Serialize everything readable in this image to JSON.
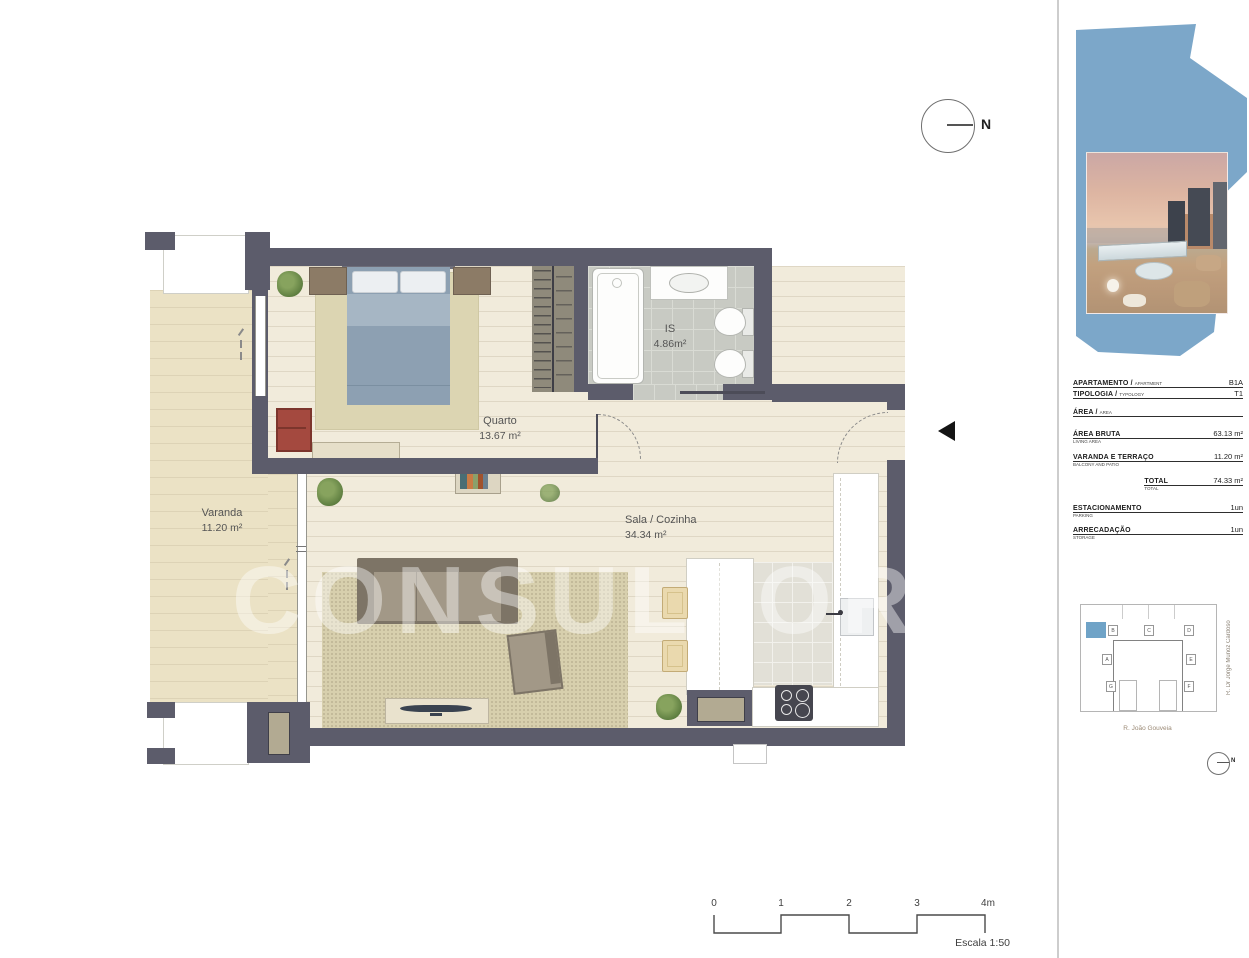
{
  "plan": {
    "watermark": "CONSULTORES",
    "north": {
      "label": "N"
    },
    "rooms": {
      "varanda": {
        "name": "Varanda",
        "area": "11.20 m²"
      },
      "quarto": {
        "name": "Quarto",
        "area": "13.67 m²"
      },
      "is": {
        "name": "IS",
        "area": "4.86m²"
      },
      "sala": {
        "name": "Sala / Cozinha",
        "area": "34.34 m²"
      }
    }
  },
  "sidebar": {
    "info_rows": [
      {
        "pt": "APARTAMENTO /",
        "en": "APARTMENT",
        "value": "B1A"
      },
      {
        "pt": "TIPOLOGIA /",
        "en": "TYPOLOGY",
        "value": "T1"
      },
      {
        "pt": "ÁREA /",
        "en": "AREA",
        "value": ""
      },
      {
        "pt": "ÁREA BRUTA",
        "en": "LIVING AREA",
        "value": "63.13 m²"
      },
      {
        "pt": "VARANDA E TERRAÇO",
        "en": "BALCONY AND PATIO",
        "value": "11.20 m²"
      },
      {
        "pt": "TOTAL",
        "en": "TOTAL",
        "value": "74.33 m²"
      },
      {
        "pt": "ESTACIONAMENTO",
        "en": "PARKING",
        "value": "1un"
      },
      {
        "pt": "ARRECADAÇÃO",
        "en": "STORAGE",
        "value": "1un"
      }
    ],
    "keyplan": {
      "units": [
        "B",
        "C",
        "D",
        "A",
        "E",
        "G",
        "F"
      ],
      "highlighted_unit": "B",
      "street_bottom": "R. João Gouveia",
      "street_right": "R. Dr Jorge Munoz Cardoso",
      "north_label": "N"
    }
  },
  "scalebar": {
    "ticks": [
      "0",
      "1",
      "2",
      "3",
      "4m"
    ],
    "label": "Escala 1:50"
  },
  "colors": {
    "wall": "#5c5c6b",
    "floor": "#f1ebdb",
    "balcony": "#ebe2c5",
    "accent_blue": "#7ca7c9",
    "highlight_unit": "#6fa3c7"
  }
}
